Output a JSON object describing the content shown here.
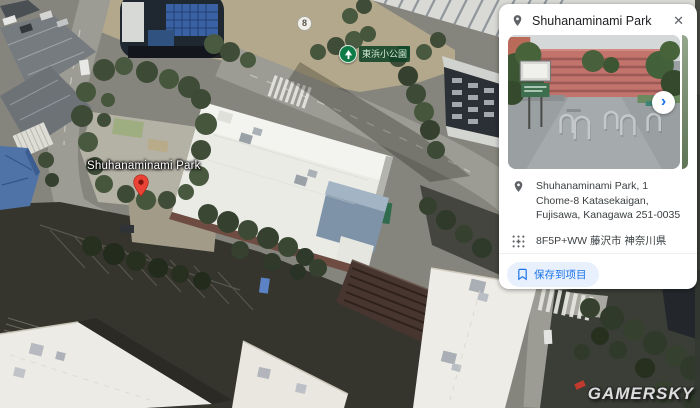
{
  "map": {
    "route_badge": "8",
    "park_poi_label": "東浜小公園",
    "place_label": "Shuhanaminami Park"
  },
  "watermark": "GAMERSKY",
  "panel": {
    "title": "Shuhanaminami Park",
    "close": "✕",
    "photo_next": "›",
    "address": "Shuhanaminami Park, 1 Chome-8 Katasekaigan, Fujisawa, Kanagawa 251-0035",
    "plus_code": "8F5P+WW 藤沢市 神奈川県",
    "save_label": "保存到项目"
  },
  "colors": {
    "accent": "#1a73e8",
    "save_bg": "#e8f0fe",
    "poi_green": "#0f7b46",
    "pin_red": "#ea4335"
  }
}
